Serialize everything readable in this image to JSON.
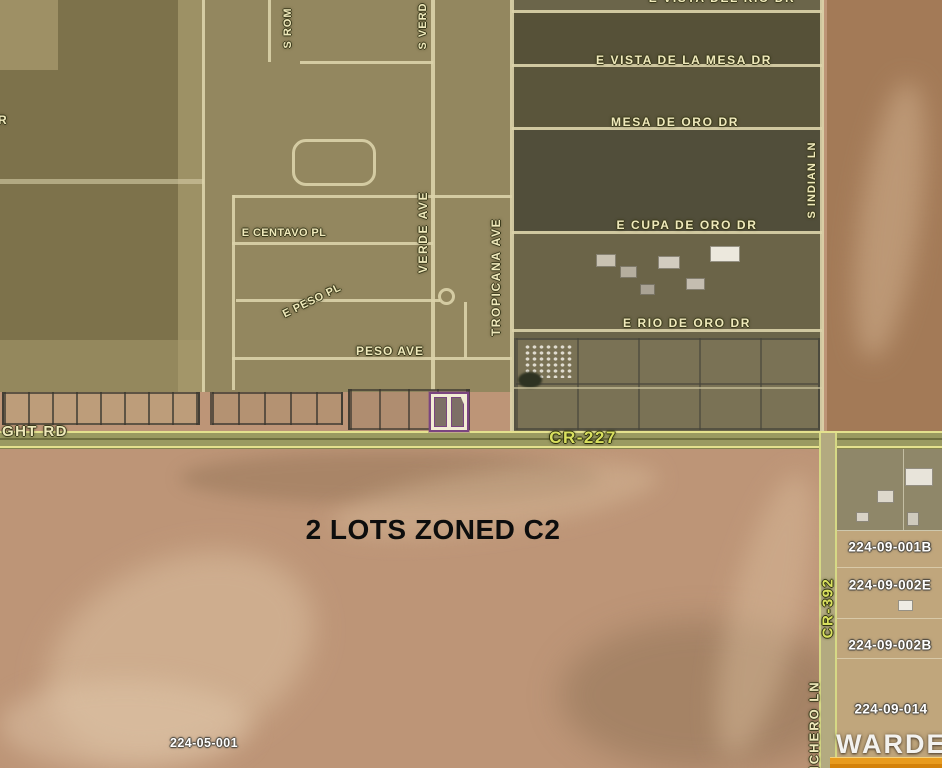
{
  "streets": {
    "horizontal": [
      {
        "name": "e-vista-del-rio-dr",
        "label": "E VISTA DEL RIO DR"
      },
      {
        "name": "e-vista-de-la-mesa-dr",
        "label": "E VISTA DE LA MESA DR"
      },
      {
        "name": "mesa-de-oro-dr",
        "label": "MESA DE ORO DR"
      },
      {
        "name": "e-cupa-de-oro-dr",
        "label": "E CUPA DE ORO DR"
      },
      {
        "name": "e-rio-de-oro-dr",
        "label": "E RIO DE ORO DR"
      },
      {
        "name": "e-centavo-pl",
        "label": "E CENTAVO PL"
      },
      {
        "name": "e-peso-pl",
        "label": "E PESO PL"
      },
      {
        "name": "peso-ave",
        "label": "PESO AVE"
      },
      {
        "name": "ght-rd",
        "label": "GHT RD"
      }
    ],
    "vertical": [
      {
        "name": "s-rom",
        "label": "S ROM"
      },
      {
        "name": "s-verd",
        "label": "S VERD"
      },
      {
        "name": "verde-ave",
        "label": "VERDE AVE"
      },
      {
        "name": "tropicana-ave",
        "label": "TROPICANA AVE"
      },
      {
        "name": "s-indian-ln",
        "label": "S INDIAN LN"
      },
      {
        "name": "nchero-ln",
        "label": "NCHERO LN"
      }
    ],
    "county_roads": [
      {
        "name": "cr-227",
        "label": "CR-227"
      },
      {
        "name": "cr-392",
        "label": "CR-392"
      }
    ],
    "edge_partial_label": "R"
  },
  "annotation": {
    "zoning_note": "2 LOTS ZONED C2",
    "lots_count": 2
  },
  "parcel_numbers": [
    {
      "apn": "224-05-001"
    },
    {
      "apn": "224-09-001B"
    },
    {
      "apn": "224-09-002E"
    },
    {
      "apn": "224-09-002B"
    },
    {
      "apn": "224-09-014"
    }
  ],
  "highlight": {
    "border_color": "#7b4580",
    "fill_color": "#f2ecd4"
  },
  "watermark": {
    "brand": "WARDEX",
    "bar_color": "#e89b1e"
  },
  "colors": {
    "road_label": "#d9e05f",
    "street_label": "#efe9bb",
    "apn_label": "#ffffff",
    "zoning_text": "#0d0d0d",
    "road_fill": "#9a9a61",
    "road_edge": "#e4e18e"
  }
}
